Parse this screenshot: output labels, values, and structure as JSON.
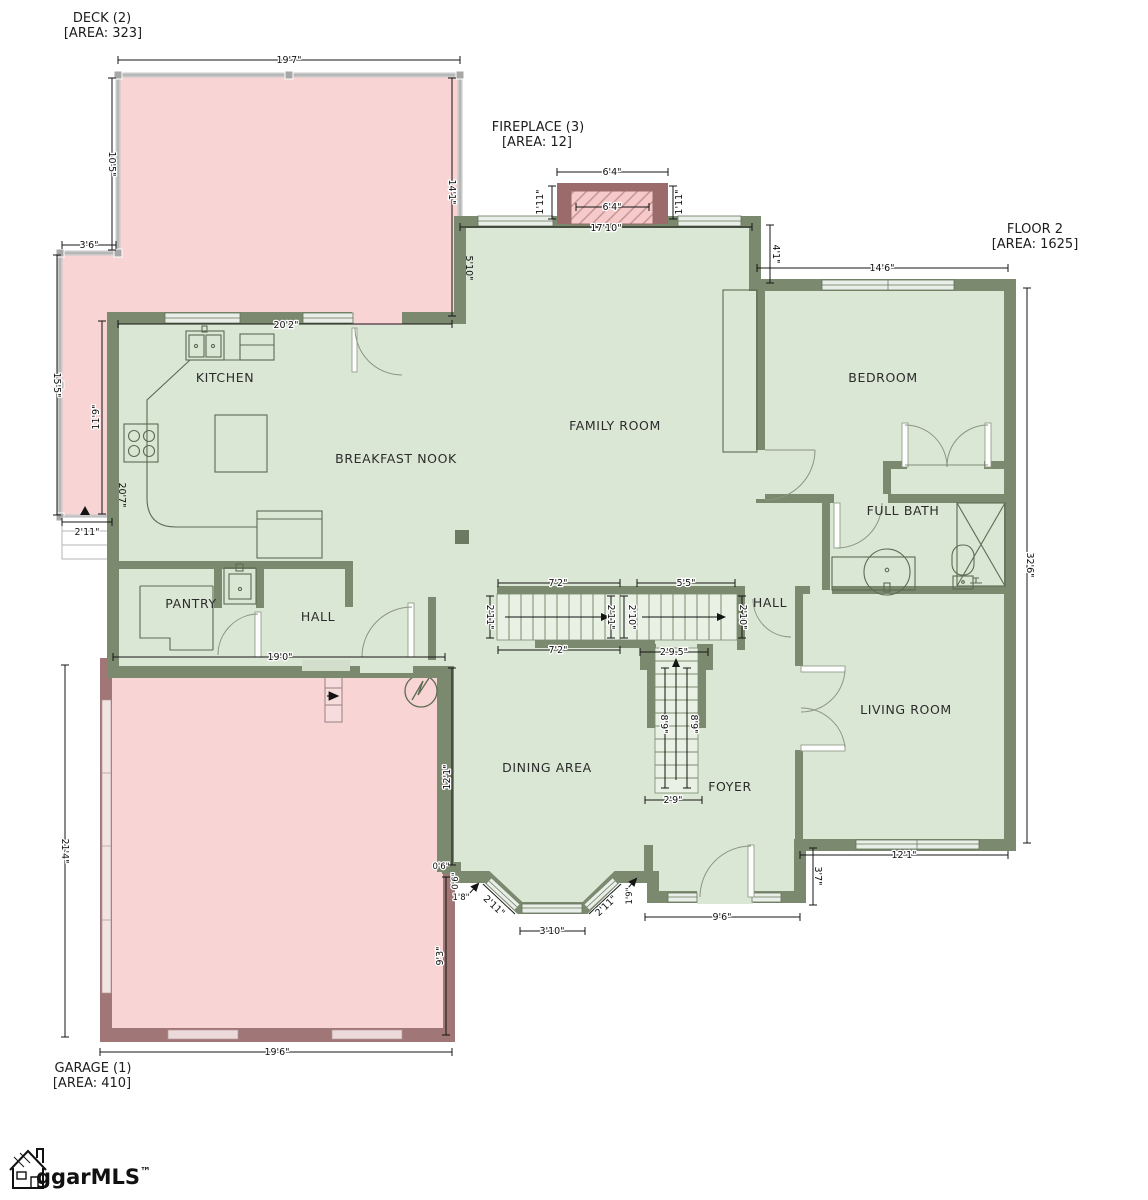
{
  "zones": {
    "deck": {
      "name": "DECK (2)",
      "area": "[AREA: 323]"
    },
    "fireplace": {
      "name": "FIREPLACE (3)",
      "area": "[AREA: 12]"
    },
    "floor2": {
      "name": "FLOOR 2",
      "area": "[AREA: 1625]"
    },
    "garage": {
      "name": "GARAGE (1)",
      "area": "[AREA: 410]"
    }
  },
  "rooms": {
    "kitchen": "KITCHEN",
    "breakfast_nook": "BREAKFAST NOOK",
    "family_room": "FAMILY ROOM",
    "bedroom": "BEDROOM",
    "full_bath": "FULL BATH",
    "hall_upper": "HALL",
    "pantry": "PANTRY",
    "hall_lower": "HALL",
    "living_room": "LIVING ROOM",
    "dining_area": "DINING AREA",
    "foyer": "FOYER"
  },
  "dims": {
    "deck_top": "19'7\"",
    "deck_left": "10'5\"",
    "deck_step": "3'6\"",
    "deck_strip": "15'5\"",
    "deck_inner": "11'9\"",
    "kitchen_left_wall": "20'7\"",
    "deck_strip_width": "2'11\"",
    "deck_right": "14'1\"",
    "family_left_wall": "5'10\"",
    "kitchen_top": "20'2\"",
    "fireplace_width": "6'4\"",
    "fireplace_inner": "6'4\"",
    "fireplace_side_left": "1'11\"",
    "fireplace_side_right": "1'11\"",
    "family_top": "17'10\"",
    "family_step": "4'1\"",
    "bedroom_top": "14'6\"",
    "right_wall": "32'6\"",
    "living_bottom": "12'1\"",
    "foyer_side": "3'7\"",
    "entry": "9'6\"",
    "bay_step_a": "0'6\"",
    "bay_step_b": "0'6\"",
    "bay_left": "1'8\"",
    "bay_diag_left": "2'11\"",
    "bay_bottom": "3'10\"",
    "bay_diag_right": "2'11\"",
    "bay_right": "1'9\"",
    "garage_top": "19'0\"",
    "garage_left": "21'4\"",
    "garage_right_upper": "12'1\"",
    "garage_right_lower": "9'3\"",
    "garage_bottom": "19'6\"",
    "stair_left_top": "7'2\"",
    "stair_left_bottom": "7'2\"",
    "stair_right_top": "5'5\"",
    "stair_w1": "2'11\"",
    "stair_w2": "2'11\"",
    "stair_w3": "2'10\"",
    "stair_w4": "2'10\"",
    "stair_down_top": "2'9.5\"",
    "stair_down_l": "8'9\"",
    "stair_down_r": "8'9\"",
    "stair_down_bottom": "2'9\""
  },
  "logo": {
    "brand": "ggarMLS",
    "tm": "™"
  },
  "colors": {
    "floor": "#dbe7d5",
    "wall": "#7b8a6f",
    "deck": "#f8d4d4",
    "exterior_accent": "#a07676",
    "fireplace_wall": "#9b6a6a",
    "window": "#e9efe8",
    "dimension": "#141414"
  }
}
